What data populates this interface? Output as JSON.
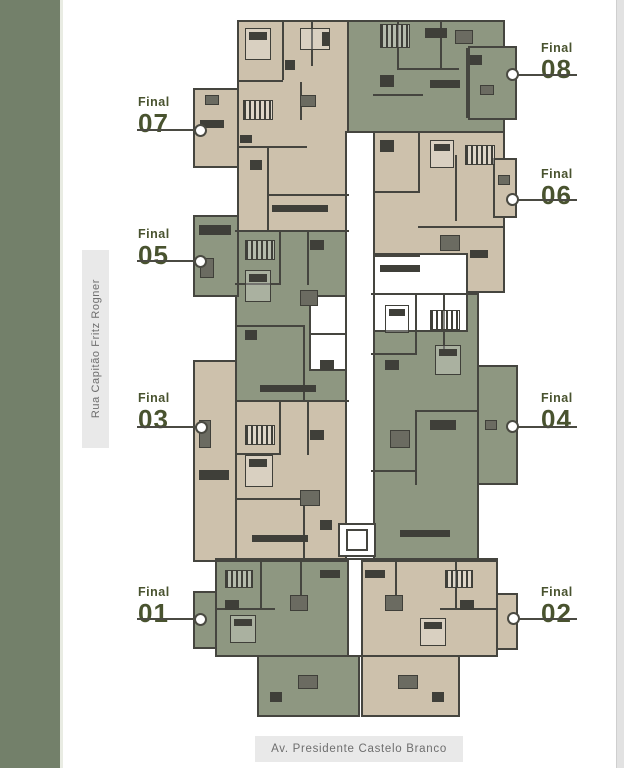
{
  "image_type": "residential floor plan diagram",
  "streets": {
    "left": "Rua Capitão Fritz Rogner",
    "bottom": "Av. Presidente Castelo Branco"
  },
  "watermark": {
    "text": "AC Imóveis"
  },
  "units": {
    "u01": {
      "word": "Final",
      "number": "01",
      "side": "left",
      "fill": "green"
    },
    "u02": {
      "word": "Final",
      "number": "02",
      "side": "right",
      "fill": "beige"
    },
    "u03": {
      "word": "Final",
      "number": "03",
      "side": "left",
      "fill": "beige"
    },
    "u04": {
      "word": "Final",
      "number": "04",
      "side": "right",
      "fill": "green"
    },
    "u05": {
      "word": "Final",
      "number": "05",
      "side": "left",
      "fill": "green"
    },
    "u06": {
      "word": "Final",
      "number": "06",
      "side": "right",
      "fill": "beige"
    },
    "u07": {
      "word": "Final",
      "number": "07",
      "side": "left",
      "fill": "beige"
    },
    "u08": {
      "word": "Final",
      "number": "08",
      "side": "right",
      "fill": "green"
    }
  },
  "colors": {
    "unit_beige": "#cdc1ac",
    "unit_green": "#8e9781",
    "wall": "#45453f",
    "street_strip_green": "#73806a",
    "label_text": "#49532f",
    "street_bar_bg": "#e9e9e9",
    "street_bar_text": "#6e6e6e",
    "watermark_blue": "#3d63cf",
    "watermark_orange": "#e0a23e"
  }
}
